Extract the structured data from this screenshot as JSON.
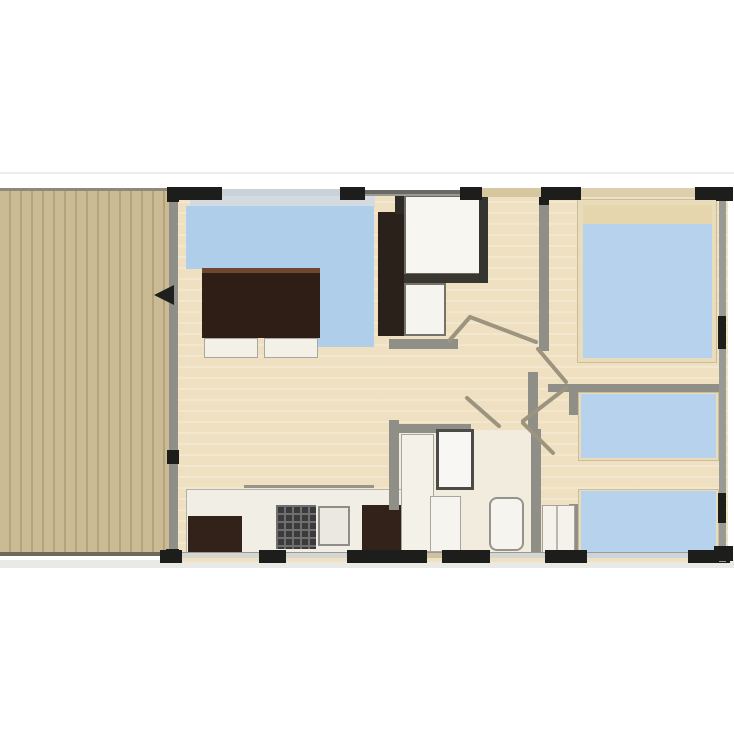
{
  "canvas": {
    "width": 734,
    "height": 735,
    "background": "#ffffff"
  },
  "palette": {
    "deck_plank": "#cbbb95",
    "deck_gap": "#b4a37b",
    "floor_wood": "#eee0c1",
    "floor_bathroom": "#f2ecdf",
    "sofa_blue": "#aecee9",
    "bed_blue": "#b7d2ec",
    "bed_frame": "#e9dcbb",
    "pillow_tan": "#e6d6ad",
    "furniture_dark": "#33221a",
    "wall_gray": "#9a9a95",
    "wall_black": "#1d1d1b",
    "wall_tan": "#d7c7a1",
    "fixture_white": "#f6f4ee",
    "door_line": "#9c947e"
  },
  "shapes": [
    {
      "name": "page-hairline",
      "kind": "rect",
      "x": 0,
      "y": 172,
      "w": 734,
      "h": 2,
      "fill": "#ededea"
    },
    {
      "name": "plan-shadow",
      "kind": "rect",
      "x": 0,
      "y": 560,
      "w": 734,
      "h": 8,
      "fill": "#e9e9e5"
    },
    {
      "name": "terrace-deck",
      "kind": "deck",
      "x": 0,
      "y": 190,
      "w": 177,
      "h": 366,
      "fill": "#cbbb95",
      "stripe": "#b4a37b"
    },
    {
      "name": "terrace-top-edge",
      "kind": "rect",
      "x": 0,
      "y": 188,
      "w": 177,
      "h": 3,
      "fill": "#8e8a79"
    },
    {
      "name": "terrace-bottom-edge",
      "kind": "rect",
      "x": 0,
      "y": 552,
      "w": 177,
      "h": 4,
      "fill": "#6e6a5b"
    },
    {
      "name": "interior-floor",
      "kind": "wood",
      "x": 169,
      "y": 190,
      "w": 559,
      "h": 372,
      "fill": "#eee0c1"
    },
    {
      "name": "bathroom-floor",
      "kind": "rect",
      "x": 396,
      "y": 430,
      "w": 136,
      "h": 124,
      "fill": "#f2ecdf"
    },
    {
      "name": "living-window-band",
      "kind": "rect",
      "x": 190,
      "y": 196,
      "w": 185,
      "h": 11,
      "fill": "#d3dbe1"
    },
    {
      "name": "corner-sofa-top",
      "kind": "rect",
      "x": 186,
      "y": 206,
      "w": 188,
      "h": 63,
      "fill": "#aecee9"
    },
    {
      "name": "corner-sofa-right-arm",
      "kind": "rect",
      "x": 317,
      "y": 269,
      "w": 57,
      "h": 78,
      "fill": "#aecee9"
    },
    {
      "name": "dining-table",
      "kind": "rect",
      "x": 202,
      "y": 268,
      "w": 118,
      "h": 70,
      "fill": "#2e1e15",
      "borderTop": "5px solid #6e4730"
    },
    {
      "name": "seat-cushion-left",
      "kind": "rect",
      "x": 204,
      "y": 338,
      "w": 54,
      "h": 20,
      "fill": "#f3f0e8",
      "border": "1px solid #a9a8a0"
    },
    {
      "name": "seat-cushion-right",
      "kind": "rect",
      "x": 264,
      "y": 338,
      "w": 54,
      "h": 20,
      "fill": "#f3f0e8",
      "border": "1px solid #a9a8a0"
    },
    {
      "name": "tv-wardrobe-unit",
      "kind": "rect",
      "x": 378,
      "y": 212,
      "w": 26,
      "h": 124,
      "fill": "#2a211a"
    },
    {
      "name": "wall-stub-entry",
      "kind": "rect",
      "x": 395,
      "y": 190,
      "w": 9,
      "h": 24,
      "fill": "#2e2a25"
    },
    {
      "name": "entry-cabinet-block",
      "kind": "rect",
      "x": 404,
      "y": 195,
      "w": 78,
      "h": 80,
      "fill": "#f8f6f1",
      "border": "2px solid #6b6a64"
    },
    {
      "name": "entry-cabinet-base-band",
      "kind": "rect",
      "x": 404,
      "y": 274,
      "w": 82,
      "h": 9,
      "fill": "#3a3731"
    },
    {
      "name": "wc-cabinet-block",
      "kind": "rect",
      "x": 404,
      "y": 283,
      "w": 42,
      "h": 53,
      "fill": "#f6f4ee",
      "border": "2px solid #74726b"
    },
    {
      "name": "wall-hall-left",
      "kind": "rect",
      "x": 479,
      "y": 190,
      "w": 9,
      "h": 93,
      "fill": "#343430"
    },
    {
      "name": "wall-wc-bottom",
      "kind": "rect",
      "x": 389,
      "y": 339,
      "w": 69,
      "h": 10,
      "fill": "#8f8e87"
    },
    {
      "name": "kitchen-counter",
      "kind": "rect",
      "x": 186,
      "y": 489,
      "w": 224,
      "h": 68,
      "fill": "#f1eee6",
      "border": "1px solid #b3b1a8"
    },
    {
      "name": "kitchen-counter-edge",
      "kind": "rect",
      "x": 244,
      "y": 485,
      "w": 130,
      "h": 3,
      "fill": "#96948c"
    },
    {
      "name": "kitchen-cabinet-left",
      "kind": "rect",
      "x": 188,
      "y": 516,
      "w": 54,
      "h": 38,
      "fill": "#33221a"
    },
    {
      "name": "kitchen-stove",
      "kind": "grid",
      "x": 276,
      "y": 505,
      "w": 40,
      "h": 44,
      "fill": "#3b3b3b",
      "grid": "#6f6f6f"
    },
    {
      "name": "kitchen-sink",
      "kind": "rect",
      "x": 318,
      "y": 506,
      "w": 32,
      "h": 40,
      "fill": "#eae8e0",
      "border": "2px solid #8f8d85"
    },
    {
      "name": "kitchen-fridge",
      "kind": "rect",
      "x": 362,
      "y": 505,
      "w": 45,
      "h": 49,
      "fill": "#33221a"
    },
    {
      "name": "wall-bathroom-left",
      "kind": "rect",
      "x": 389,
      "y": 420,
      "w": 10,
      "h": 90,
      "fill": "#8f8e87"
    },
    {
      "name": "wall-bathroom-top",
      "kind": "rect",
      "x": 389,
      "y": 424,
      "w": 82,
      "h": 9,
      "fill": "#8f8e87"
    },
    {
      "name": "bathroom-vanity",
      "kind": "rect",
      "x": 401,
      "y": 434,
      "w": 33,
      "h": 118,
      "fill": "#f4f1e9",
      "border": "1px solid #a7a59e"
    },
    {
      "name": "shower-cabin",
      "kind": "rect",
      "x": 436,
      "y": 429,
      "w": 38,
      "h": 61,
      "fill": "#f9f7f3",
      "border": "3px solid #4c4b46"
    },
    {
      "name": "bathroom-washbasin",
      "kind": "rect",
      "x": 430,
      "y": 496,
      "w": 31,
      "h": 56,
      "fill": "#f6f4ee",
      "border": "1px solid #a7a59e"
    },
    {
      "name": "toilet",
      "kind": "rect",
      "x": 489,
      "y": 497,
      "w": 35,
      "h": 54,
      "fill": "#f6f4ee",
      "border": "2px solid #95938b",
      "radius": "8px"
    },
    {
      "name": "wall-hall-stub",
      "kind": "rect",
      "x": 528,
      "y": 372,
      "w": 10,
      "h": 58,
      "fill": "#8f8e87"
    },
    {
      "name": "wall-bathroom-right",
      "kind": "rect",
      "x": 531,
      "y": 429,
      "w": 10,
      "h": 129,
      "fill": "#8f8e87"
    },
    {
      "name": "wall-master-left",
      "kind": "rect",
      "x": 539,
      "y": 190,
      "w": 10,
      "h": 161,
      "fill": "#8f8e87"
    },
    {
      "name": "wall-master-left-black",
      "kind": "rect",
      "x": 539,
      "y": 188,
      "w": 10,
      "h": 17,
      "fill": "#1d1d1b"
    },
    {
      "name": "wall-between-bedrooms",
      "kind": "rect",
      "x": 548,
      "y": 384,
      "w": 171,
      "h": 8,
      "fill": "#8f8e87"
    },
    {
      "name": "wall-bedroom2-left-upper",
      "kind": "rect",
      "x": 569,
      "y": 384,
      "w": 10,
      "h": 31,
      "fill": "#8f8e87"
    },
    {
      "name": "wall-bedroom2-left-lower",
      "kind": "rect",
      "x": 569,
      "y": 504,
      "w": 10,
      "h": 54,
      "fill": "#8f8e87"
    },
    {
      "name": "bedroom2-closet",
      "kind": "rect",
      "x": 542,
      "y": 505,
      "w": 33,
      "h": 49,
      "fill": "#f4f2ea",
      "border": "1px solid #a5a39b"
    },
    {
      "name": "bedroom2-closet-divider",
      "kind": "rect",
      "x": 556,
      "y": 506,
      "w": 2,
      "h": 47,
      "fill": "#b9b7ae"
    },
    {
      "name": "master-bed-frame",
      "kind": "rect",
      "x": 577,
      "y": 199,
      "w": 140,
      "h": 164,
      "fill": "#e9dcbb",
      "border": "1px solid #cabd98"
    },
    {
      "name": "master-bed-pillows",
      "kind": "rect",
      "x": 583,
      "y": 205,
      "w": 129,
      "h": 19,
      "fill": "#e6d6ad"
    },
    {
      "name": "master-bed-mattress",
      "kind": "rect",
      "x": 583,
      "y": 224,
      "w": 129,
      "h": 134,
      "fill": "#b7d2ec"
    },
    {
      "name": "twin-bed-1-frame",
      "kind": "rect",
      "x": 578,
      "y": 392,
      "w": 141,
      "h": 69,
      "fill": "#e9dcbb",
      "border": "1px solid #cabd98"
    },
    {
      "name": "twin-bed-1-mattress",
      "kind": "rect",
      "x": 581,
      "y": 394,
      "w": 135,
      "h": 64,
      "fill": "#b7d2ec"
    },
    {
      "name": "twin-bed-2-frame",
      "kind": "rect",
      "x": 578,
      "y": 489,
      "w": 141,
      "h": 68,
      "fill": "#e9dcbb",
      "border": "1px solid #cabd98"
    },
    {
      "name": "twin-bed-2-mattress",
      "kind": "rect",
      "x": 581,
      "y": 491,
      "w": 135,
      "h": 63,
      "fill": "#b7d2ec"
    },
    {
      "name": "wall-top-base",
      "kind": "rect",
      "x": 167,
      "y": 190,
      "w": 564,
      "h": 6,
      "fill": "#9a9a95"
    },
    {
      "name": "wall-top-window-living",
      "kind": "rect",
      "x": 222,
      "y": 189,
      "w": 118,
      "h": 7,
      "fill": "#c9d2d8"
    },
    {
      "name": "wall-top-thin-dark",
      "kind": "rect",
      "x": 365,
      "y": 190,
      "w": 95,
      "h": 4,
      "fill": "#6a6a64"
    },
    {
      "name": "wall-top-door-tan",
      "kind": "rect",
      "x": 482,
      "y": 188,
      "w": 59,
      "h": 9,
      "fill": "#d7c7a1"
    },
    {
      "name": "wall-top-window-tan",
      "kind": "rect",
      "x": 581,
      "y": 188,
      "w": 114,
      "h": 9,
      "fill": "#ddcfae"
    },
    {
      "name": "wall-top-black-1",
      "kind": "rect",
      "x": 167,
      "y": 187,
      "w": 55,
      "h": 13,
      "fill": "#1d1d1b"
    },
    {
      "name": "wall-top-black-2",
      "kind": "rect",
      "x": 340,
      "y": 187,
      "w": 25,
      "h": 13,
      "fill": "#1d1d1b"
    },
    {
      "name": "wall-top-black-3",
      "kind": "rect",
      "x": 460,
      "y": 187,
      "w": 22,
      "h": 13,
      "fill": "#1d1d1b"
    },
    {
      "name": "wall-top-black-4",
      "kind": "rect",
      "x": 541,
      "y": 187,
      "w": 40,
      "h": 13,
      "fill": "#1d1d1b"
    },
    {
      "name": "wall-top-black-5",
      "kind": "rect",
      "x": 695,
      "y": 187,
      "w": 36,
      "h": 13,
      "fill": "#1d1d1b"
    },
    {
      "name": "wall-bottom-base",
      "kind": "rect",
      "x": 160,
      "y": 552,
      "w": 570,
      "h": 6,
      "fill": "#9a9a95"
    },
    {
      "name": "wall-bottom-gap-1",
      "kind": "rect",
      "x": 182,
      "y": 553,
      "w": 77,
      "h": 5,
      "fill": "#d5d5d1"
    },
    {
      "name": "wall-bottom-gap-2",
      "kind": "rect",
      "x": 286,
      "y": 553,
      "w": 61,
      "h": 5,
      "fill": "#d5d5d1"
    },
    {
      "name": "wall-bottom-entry-door",
      "kind": "rect",
      "x": 427,
      "y": 553,
      "w": 15,
      "h": 5,
      "fill": "#cfc2a0"
    },
    {
      "name": "wall-bottom-gap-3",
      "kind": "rect",
      "x": 490,
      "y": 553,
      "w": 55,
      "h": 5,
      "fill": "#d5d5d1"
    },
    {
      "name": "wall-bottom-window",
      "kind": "rect",
      "x": 587,
      "y": 553,
      "w": 101,
      "h": 5,
      "fill": "#ccd5dc"
    },
    {
      "name": "wall-bottom-black-1",
      "kind": "rect",
      "x": 160,
      "y": 550,
      "w": 22,
      "h": 13,
      "fill": "#1d1d1b"
    },
    {
      "name": "wall-bottom-black-2",
      "kind": "rect",
      "x": 259,
      "y": 550,
      "w": 27,
      "h": 13,
      "fill": "#1d1d1b"
    },
    {
      "name": "wall-bottom-black-3",
      "kind": "rect",
      "x": 347,
      "y": 550,
      "w": 80,
      "h": 13,
      "fill": "#1d1d1b"
    },
    {
      "name": "wall-bottom-black-4",
      "kind": "rect",
      "x": 442,
      "y": 550,
      "w": 48,
      "h": 13,
      "fill": "#1d1d1b"
    },
    {
      "name": "wall-bottom-black-5",
      "kind": "rect",
      "x": 545,
      "y": 550,
      "w": 42,
      "h": 13,
      "fill": "#1d1d1b"
    },
    {
      "name": "wall-bottom-black-6",
      "kind": "rect",
      "x": 688,
      "y": 550,
      "w": 42,
      "h": 13,
      "fill": "#1d1d1b"
    },
    {
      "name": "wall-right-base",
      "kind": "rect",
      "x": 719,
      "y": 190,
      "w": 7,
      "h": 372,
      "fill": "#9a9a95"
    },
    {
      "name": "wall-right-black-top",
      "kind": "rect",
      "x": 716,
      "y": 187,
      "w": 17,
      "h": 14,
      "fill": "#1d1d1b"
    },
    {
      "name": "wall-right-black-mid",
      "kind": "rect",
      "x": 718,
      "y": 316,
      "w": 8,
      "h": 33,
      "fill": "#1d1d1b"
    },
    {
      "name": "wall-right-black-low",
      "kind": "rect",
      "x": 718,
      "y": 493,
      "w": 8,
      "h": 30,
      "fill": "#1d1d1b"
    },
    {
      "name": "wall-right-black-bottom",
      "kind": "rect",
      "x": 714,
      "y": 546,
      "w": 19,
      "h": 15,
      "fill": "#1d1d1b"
    },
    {
      "name": "wall-facade-left",
      "kind": "rect",
      "x": 169,
      "y": 190,
      "w": 9,
      "h": 372,
      "fill": "#8f8e87"
    },
    {
      "name": "wall-facade-black-top",
      "kind": "rect",
      "x": 167,
      "y": 189,
      "w": 12,
      "h": 13,
      "fill": "#1d1d1b"
    },
    {
      "name": "wall-facade-black-mid",
      "kind": "rect",
      "x": 167,
      "y": 450,
      "w": 12,
      "h": 14,
      "fill": "#1d1d1b"
    },
    {
      "name": "wall-facade-black-bottom",
      "kind": "rect",
      "x": 166,
      "y": 549,
      "w": 13,
      "h": 13,
      "fill": "#1d1d1b"
    },
    {
      "name": "terrace-entry-arrow",
      "kind": "triangle-left",
      "x": 154,
      "y": 285,
      "w": 20,
      "h": 20,
      "fill": "#1f1f1e"
    }
  ],
  "door_lines": [
    {
      "name": "door-swing-hall",
      "x1": 470,
      "y1": 317,
      "x2": 536,
      "y2": 342
    },
    {
      "name": "door-swing-hall-short",
      "x1": 449,
      "y1": 341,
      "x2": 470,
      "y2": 317
    },
    {
      "name": "door-swing-master",
      "x1": 538,
      "y1": 349,
      "x2": 566,
      "y2": 382
    },
    {
      "name": "door-swing-bedroom2-a",
      "x1": 566,
      "y1": 388,
      "x2": 523,
      "y2": 421
    },
    {
      "name": "door-swing-bedroom2-b",
      "x1": 523,
      "y1": 423,
      "x2": 553,
      "y2": 453
    },
    {
      "name": "door-swing-bathroom",
      "x1": 467,
      "y1": 398,
      "x2": 499,
      "y2": 426
    }
  ],
  "door_line_style": {
    "stroke": "#9c947e",
    "width": 4
  }
}
